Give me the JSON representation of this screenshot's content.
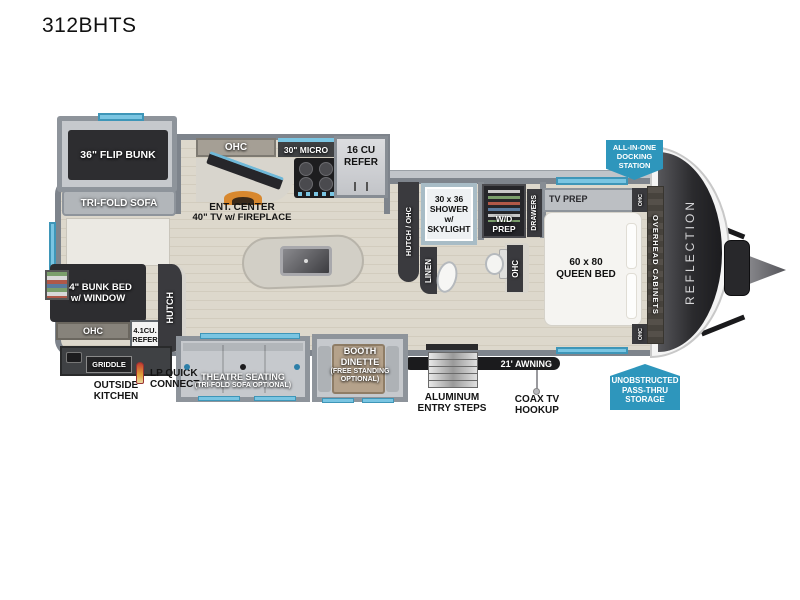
{
  "title": "312BHTS",
  "labels": {
    "flip_bunk": "36\" FLIP BUNK",
    "trifold_sofa": "TRI-FOLD SOFA",
    "bunk_bed": [
      "44\" BUNK BED",
      "w/ WINDOW"
    ],
    "ohc": "OHC",
    "small_refer": [
      "4.1CU.",
      "REFER"
    ],
    "hutch": "HUTCH",
    "griddle": "GRIDDLE",
    "outside_kitchen": [
      "OUTSIDE",
      "KITCHEN"
    ],
    "lp_quick_connect": [
      "LP QUICK",
      "CONNECT"
    ],
    "ent_center": [
      "ENT. CENTER",
      "40\" TV w/ FIREPLACE"
    ],
    "micro": "30\" MICRO",
    "refer": [
      "16 CU",
      "REFER"
    ],
    "hutch_ohc": "HUTCH / OHC",
    "shower": [
      "30 x 36",
      "SHOWER",
      "w/ SKYLIGHT"
    ],
    "wd_prep": "W/D PREP",
    "drawers": "DRAWERS",
    "linen": "LINEN",
    "tv_prep": "TV PREP",
    "queen_bed": [
      "60 x 80",
      "QUEEN BED"
    ],
    "overhead_cabinets": "OVERHEAD CABINETS",
    "reflection": "REFLECTION",
    "theatre": [
      "THEATRE SEATING",
      "(TRI-FOLD SOFA OPTIONAL)"
    ],
    "booth_dinette": [
      "BOOTH",
      "DINETTE",
      "(FREE STANDING",
      "OPTIONAL)"
    ],
    "entry_steps": [
      "ALUMINUM",
      "ENTRY STEPS"
    ],
    "awning": "21' AWNING",
    "coax": [
      "COAX TV",
      "HOOKUP"
    ]
  },
  "badges": {
    "docking": [
      "ALL-IN-ONE",
      "DOCKING",
      "STATION"
    ],
    "storage": [
      "UNOBSTRUCTED",
      "PASS-THRU",
      "STORAGE"
    ]
  },
  "colors": {
    "badge_blue": "#2e96bc",
    "dark_cabinet": "#2d2d30",
    "wall_gray": "#7e848c",
    "window_blue": "#7ac5e2",
    "floor_wood": "#d8d2c5",
    "awning_black": "#1b1b1d",
    "fireplace_orange": "#d8882e"
  }
}
